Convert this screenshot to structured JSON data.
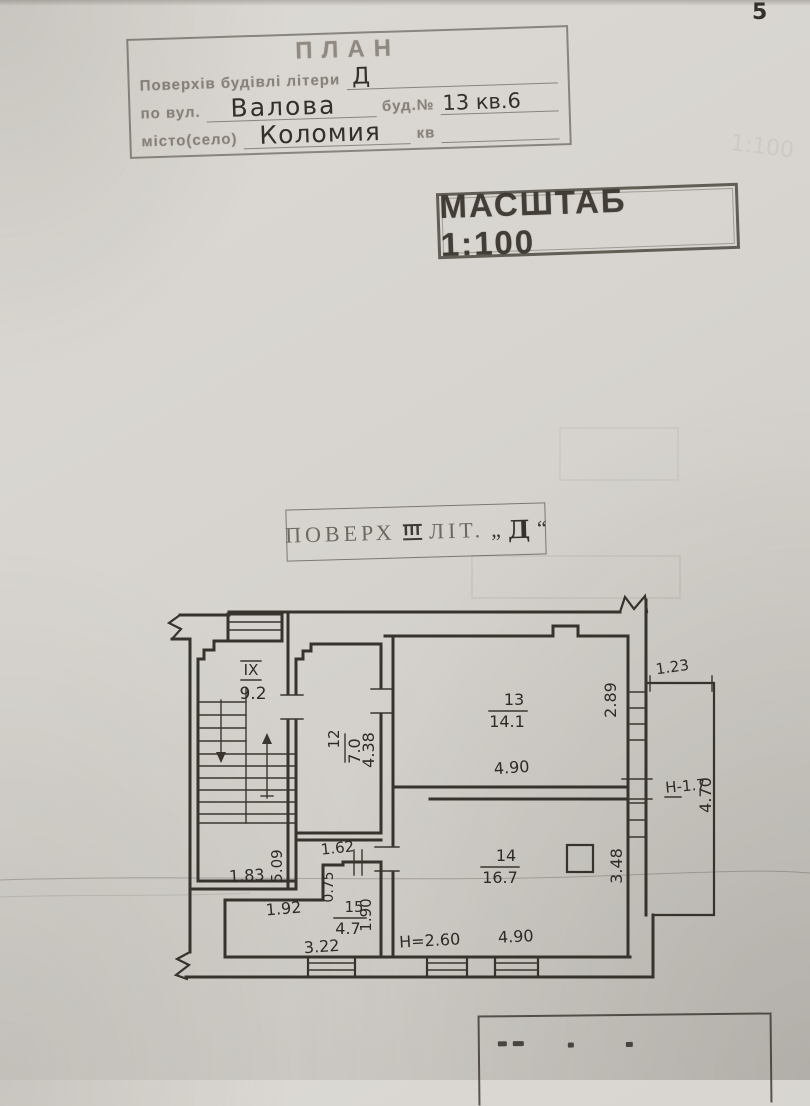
{
  "page": {
    "number": "5"
  },
  "plan_stamp": {
    "title": "ПЛАН",
    "row1_label": "Поверхів будівлі літери",
    "row1_value": "Д",
    "row2_label": "по вул.",
    "row2_value": "Валова",
    "row2_label2": "буд.№",
    "row2_value2": "13 кв.6",
    "row3_label": "місто(село)",
    "row3_value": "Коломия",
    "row3_label2": "кв"
  },
  "scale_stamp": {
    "text": "МАСШТАБ 1:100"
  },
  "floor_stamp": {
    "prefix": "ПОВЕРХ",
    "numeral": "III",
    "lit": "ЛІТ.",
    "quote_open": "„",
    "letter": "Д",
    "quote_close": "“"
  },
  "floor_plan": {
    "rooms": [
      {
        "number": "IX",
        "area": "9.2"
      },
      {
        "number": "12",
        "area": "7.0"
      },
      {
        "number": "13",
        "area": "14.1"
      },
      {
        "number": "14",
        "area": "16.7"
      },
      {
        "number": "15",
        "area": "4.7"
      }
    ],
    "dims": {
      "stair_landing_width": "1.83",
      "stair_flight_depth": "5.09",
      "room12_depth": "4.38",
      "room13_width": "4.90",
      "room13_right_side": "2.89",
      "balcony_width": "1.23",
      "balcony_height": "Н-1.7",
      "balcony_depth": "4.70",
      "room14_right_side": "3.48",
      "room14_width": "4.90",
      "room14_ceiling_height": "Н=2.60",
      "hall_passage_width": "1.62",
      "hall_notch_depth": "0.75",
      "hall_top_width": "1.92",
      "hall_right_side": "1.90",
      "hall_bottom_width": "3.22"
    }
  }
}
